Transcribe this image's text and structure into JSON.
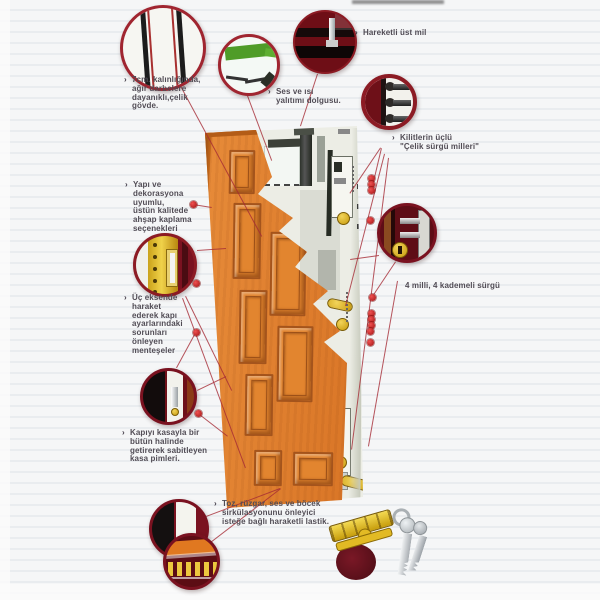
{
  "colors": {
    "wood": "#dd7b28",
    "wood_dark": "#b05a1a",
    "steel_white": "#ecede5",
    "circle_rim": "#8c1b24",
    "leader_line": "#a52a34",
    "marker_dot": "#c42020",
    "brass": "#d8a51e",
    "insulation_green": "#57a22e",
    "text": "#514c55"
  },
  "labels": {
    "celik_govde": {
      "bullet": "›",
      "text": "7cm. kalınlığında,\nağır darbelere\ndayanıklı,çelik\ngövde."
    },
    "ahsap_kaplama": {
      "bullet": "›",
      "text": "Yapı ve\ndekorasyona\nuyumlu,\nüstün kalitede\nahşap kaplama\nseçenekleri"
    },
    "menteseler": {
      "bullet": "›",
      "text": "Üç eksende\nharaket\nederek kapı\nayarlarındaki\nsorunları\nönleyen\nmenteşeler"
    },
    "kasa_pimleri": {
      "bullet": "›",
      "text": "Kapıyı kasayla bir\nbütün halinde\ngetirerek sabitleyen\nkasa pimleri."
    },
    "yalitim": {
      "bullet": "›",
      "text": "Ses ve ısı\nyalıtımı dolgusu."
    },
    "ust_mil": {
      "bullet": "›",
      "text": "Hareketli üst mil"
    },
    "surgu_milleri": {
      "bullet": "›",
      "text": "Kilitlerin üçlü\n\"Çelik sürgü milleri\""
    },
    "kademeli_surgu": {
      "bullet": "",
      "text": "4 milli, 4 kademeli sürgü"
    },
    "lastik": {
      "bullet": "›",
      "text": "Toz, rüzgar, ses ve böcek\nsirkülasyonunu önleyici\nisteğe bağlı haraketli lastik."
    }
  },
  "details": {
    "circles": [
      "door-cross-section",
      "insulation-foam",
      "top-pivot-mil",
      "steel-bolt-pins",
      "multi-stage-lock",
      "hinge",
      "frame-pin",
      "door-bottom-edge",
      "rubber-seal",
      "cylinder-and-keys"
    ]
  }
}
